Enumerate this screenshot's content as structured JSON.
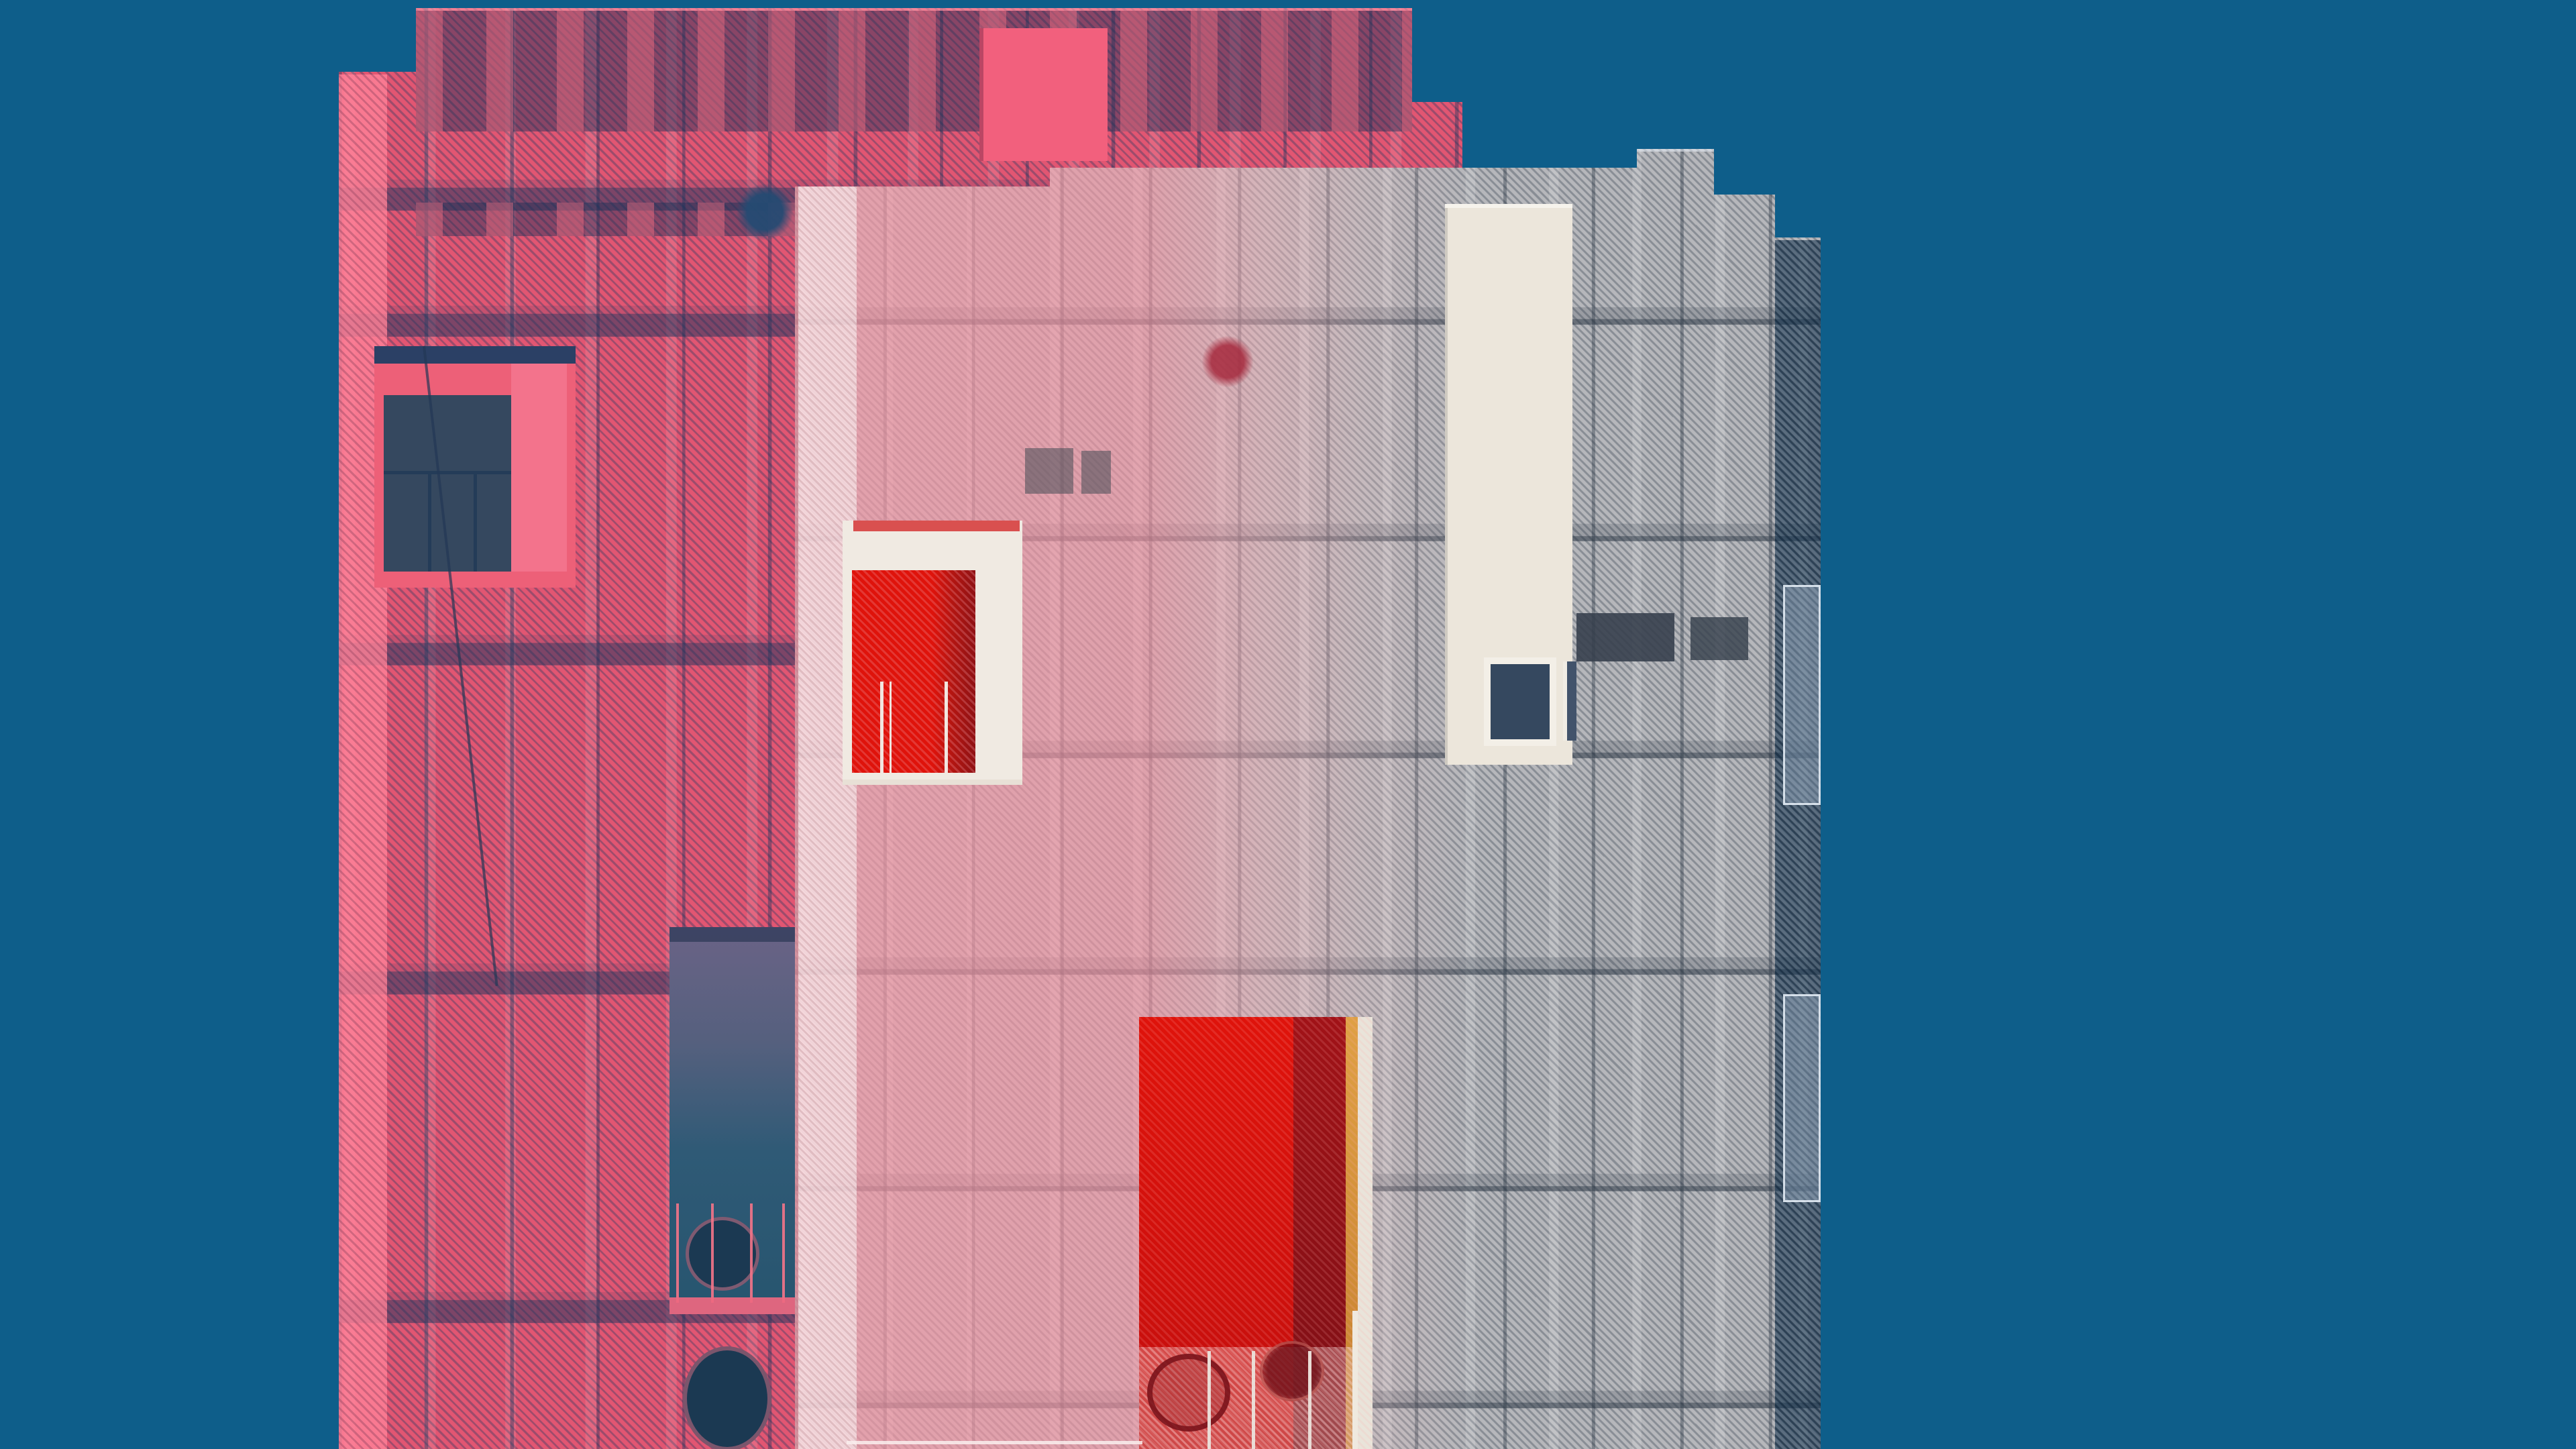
{
  "image": {
    "type": "photograph",
    "subject": "double-exposure of two mesh-clad building facades against a clear sky",
    "style": "abstract architectural photography, duotone pink/gray on teal",
    "text_content": "none"
  },
  "palette": {
    "sky": "#0e5e8a",
    "pink_base": "#e25672",
    "pink_panel": "#f2607d",
    "pink_recess": "#ed6078",
    "gray_base": "#b6b7bb",
    "cream": "#ece6db",
    "glass_dark": "#35485f",
    "frame_white": "#f0eae2",
    "red_bright": "#df130b",
    "red_dark": "#a11217",
    "orange": "#dfa044",
    "circle_navy": "#1b3952"
  },
  "elements": {
    "sky": "solid teal background",
    "building_pink": "rear facade tinted pink, perforated metal mesh with vertical panel seams and horizontal floor bands",
    "building_gray": "front facade in gray mesh, left side washed pink where exposures overlap",
    "pink_solid_panel": "bright pink rooftop panel",
    "pink_window": "recessed window with dark glass and railing",
    "pink_opening": "tall dark opening with railing, sill and circular port",
    "white_cladding_panel": "cream vertical solid panel with small dark window",
    "recessed_dark_bands": "two dark recessed ribbon windows behind mesh",
    "upper_red_window": "white-framed window with bright red reveal and thin railings",
    "red_opening": "large bright red loggia opening with shadowed jamb, orange and white reveal strips, two round vents and pale railing posts",
    "mesh_knots": "dark navy knot on pink facade, dark red knot on washed zone",
    "right_fins": "translucent mesh fins stepping out on right edge"
  }
}
